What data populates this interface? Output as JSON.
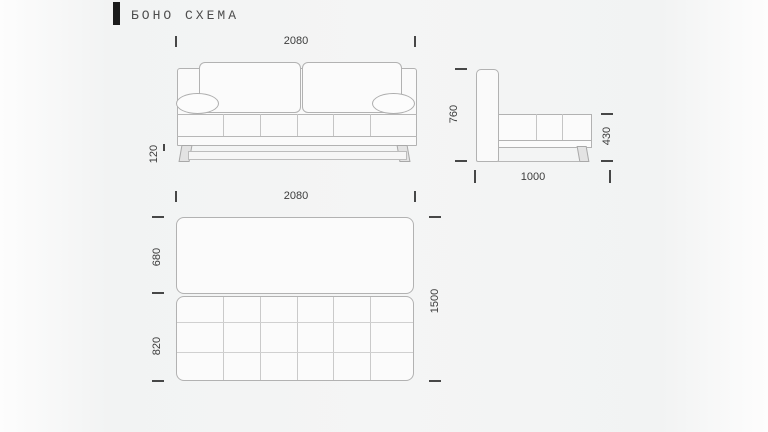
{
  "title": {
    "text": "БОНО СХЕМА"
  },
  "colors": {
    "accent_bar": "#1b1b1b",
    "outline_line": "#b2b2b2",
    "inner_line": "#c5c5c5",
    "dimension_text": "#3c3c3c",
    "leg_fill": "#e3e3e3",
    "background": "#f4f5f5"
  },
  "views": {
    "front": {
      "label": "front-view",
      "width_label": "2080",
      "leg_height_label": "120"
    },
    "side": {
      "label": "side-view",
      "height_label": "760",
      "seat_height_label": "430",
      "depth_label": "1000"
    },
    "top": {
      "label": "top-view-unfolded",
      "width_label": "2080",
      "seat_section_label": "680",
      "bed_section_label": "820",
      "total_depth_label": "1500"
    }
  }
}
